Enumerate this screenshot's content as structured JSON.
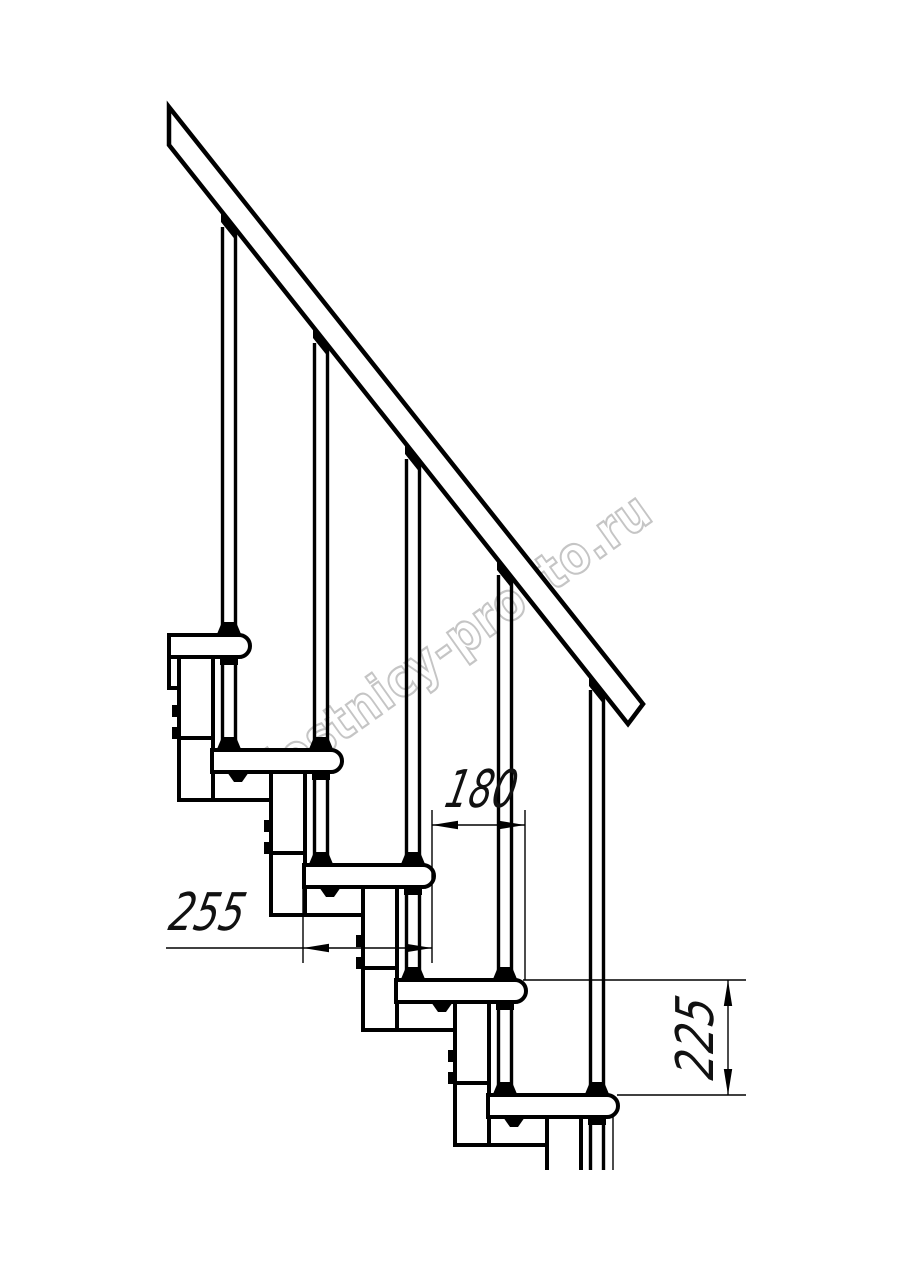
{
  "drawing": {
    "title": "staircase-side-view-technical-drawing",
    "background": "#ffffff",
    "line_color": "#000000",
    "dimensions": {
      "run": {
        "value": "180"
      },
      "depth": {
        "value": "255"
      },
      "rise": {
        "value": "225"
      }
    },
    "watermark": {
      "text": "lestnicy-prosto.ru",
      "color": "#c5c5c5"
    }
  }
}
